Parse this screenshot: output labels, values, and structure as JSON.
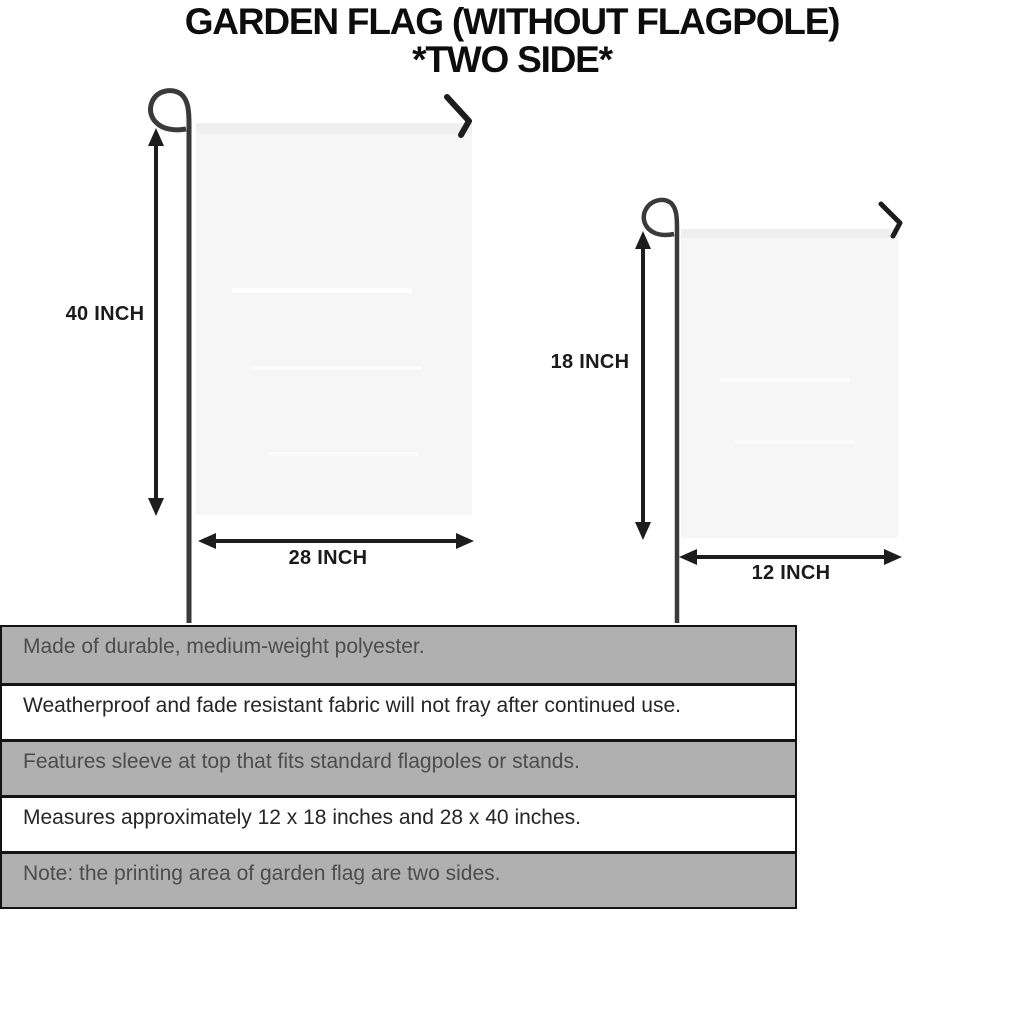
{
  "title": {
    "line1": "GARDEN FLAG (WITHOUT FLAGPOLE)",
    "line2": "*TWO SIDE*"
  },
  "diagram": {
    "large_flag": {
      "height_label": "40 INCH",
      "width_label": "28 INCH"
    },
    "small_flag": {
      "height_label": "18 INCH",
      "width_label": "12 INCH"
    }
  },
  "features": [
    "Made of durable, medium-weight polyester.",
    "Weatherproof and fade resistant fabric will not fray after continued use.",
    "Features sleeve at top that fits standard flagpoles or stands.",
    "Measures approximately 12 x 18 inches and 28 x 40 inches.",
    "Note: the printing area of garden flag are two sides."
  ],
  "colors": {
    "row_gray": "#b0b0b0",
    "row_white": "#ffffff",
    "table_border": "#141414",
    "flag_fill": "#f6f6f6",
    "pole": "#3a3a3a",
    "ink": "#1b1b1b"
  }
}
